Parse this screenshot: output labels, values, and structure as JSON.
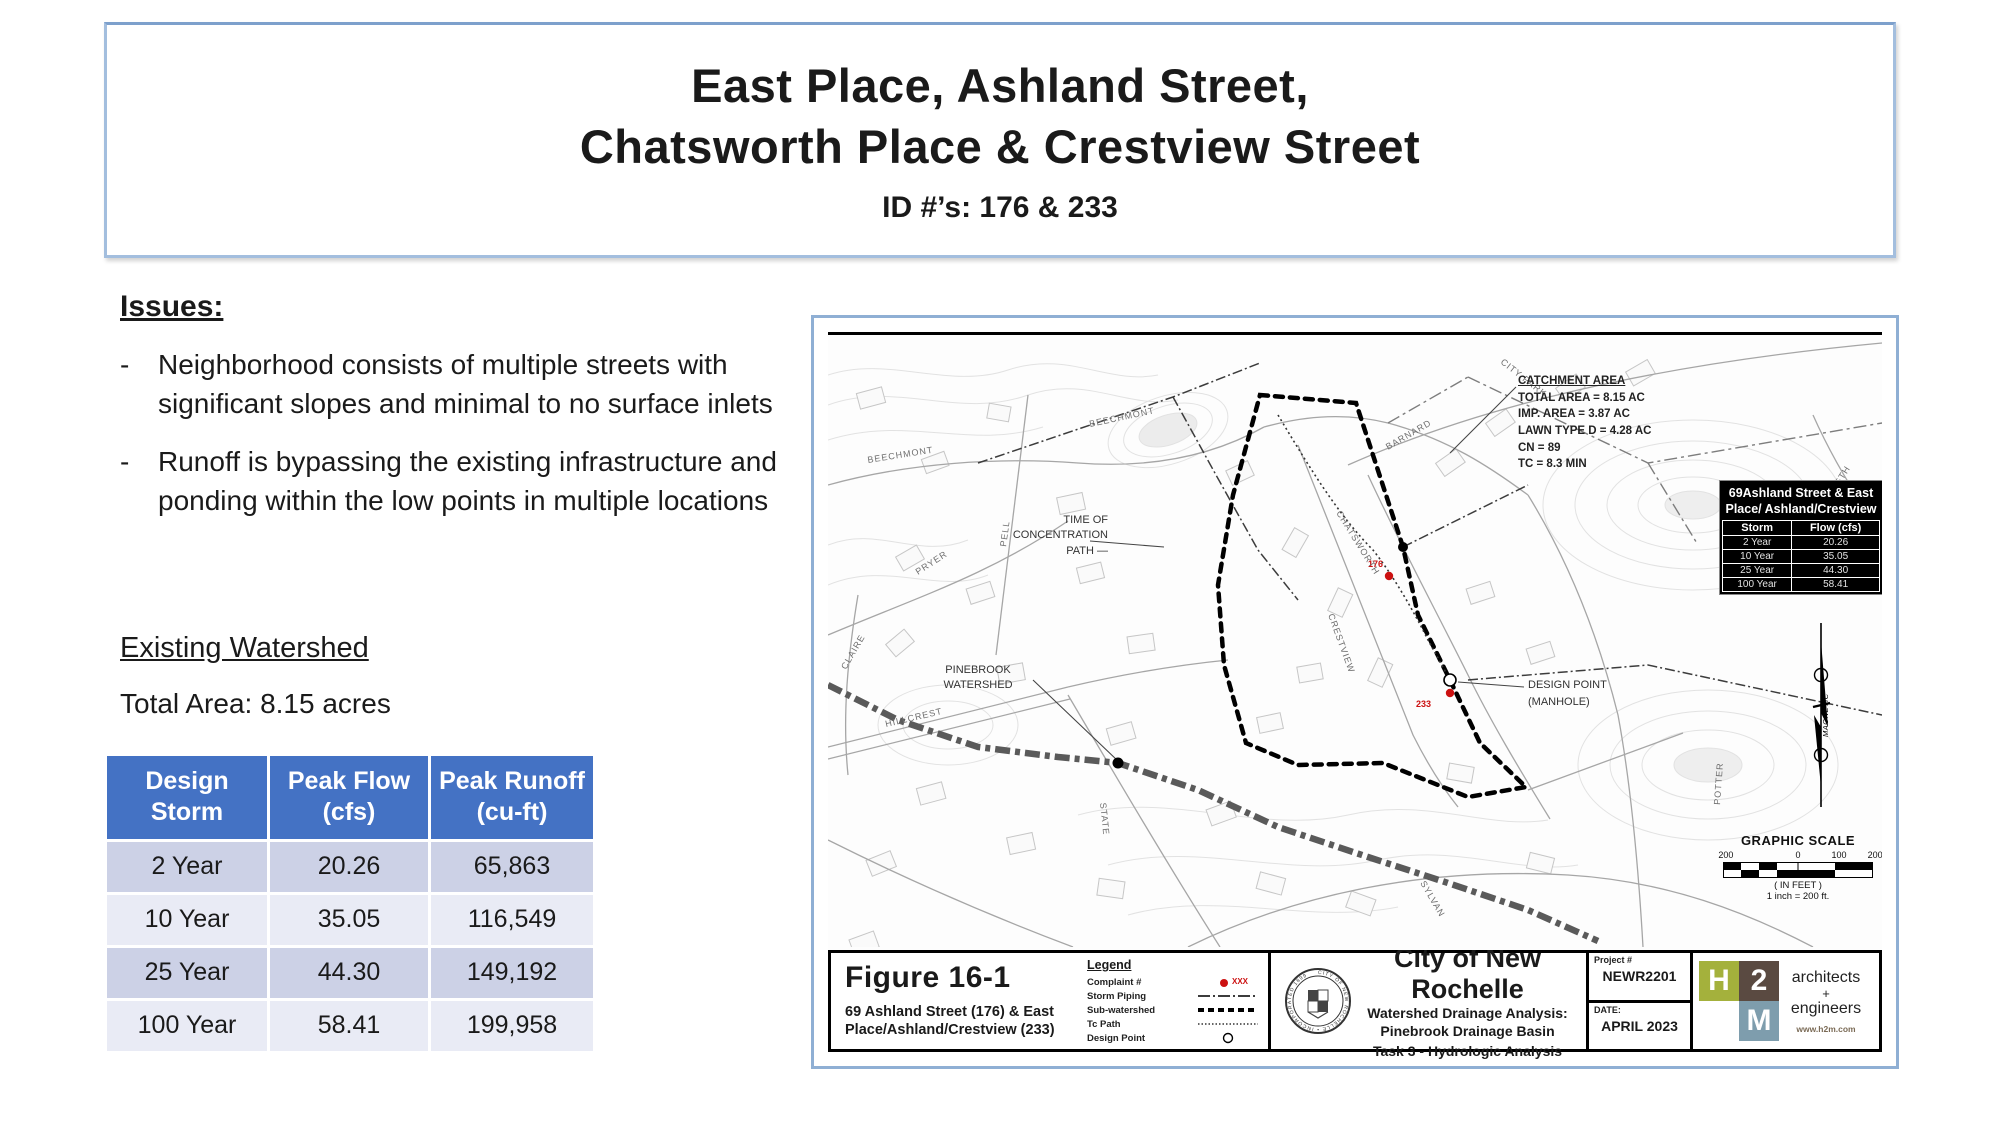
{
  "title": {
    "line1": "East Place, Ashland Street,",
    "line2": "Chatsworth Place & Crestview Street",
    "subtitle": "ID #’s: 176 & 233"
  },
  "issues": {
    "heading": "Issues:",
    "dash": "-",
    "items": [
      {
        "text": "Neighborhood consists of multiple streets with significant slopes and minimal to no surface inlets"
      },
      {
        "text": "Runoff is bypassing the existing infrastructure and ponding within the low points in multiple locations"
      }
    ]
  },
  "watershed": {
    "heading": "Existing Watershed",
    "total_area": "Total Area: 8.15 acres"
  },
  "storm_table": {
    "headers": [
      "Design Storm",
      "Peak Flow (cfs)",
      "Peak Runoff (cu-ft)"
    ],
    "rows": [
      [
        "2 Year",
        "20.26",
        "65,863"
      ],
      [
        "10 Year",
        "35.05",
        "116,549"
      ],
      [
        "25 Year",
        "44.30",
        "149,192"
      ],
      [
        "100 Year",
        "58.41",
        "199,958"
      ]
    ]
  },
  "map": {
    "catchment": {
      "title": "CATCHMENT AREA",
      "line1": "TOTAL AREA = 8.15 AC",
      "line2": "IMP. AREA = 3.87 AC",
      "line3": "LAWN TYPE D = 4.28 AC",
      "line4": "CN = 89",
      "line5": "TC = 8.3 MIN"
    },
    "inset_table": {
      "title_line1": "69Ashland Street & East",
      "title_line2": "Place/ Ashland/Crestview",
      "headers": [
        "Storm",
        "Flow (cfs)"
      ],
      "rows": [
        [
          "2 Year",
          "20.26"
        ],
        [
          "10 Year",
          "35.05"
        ],
        [
          "25 Year",
          "44.30"
        ],
        [
          "100 Year",
          "58.41"
        ]
      ]
    },
    "labels": {
      "toc1": "TIME OF",
      "toc2": "CONCENTRATION",
      "toc3": "PATH —",
      "pinebrook1": "PINEBROOK",
      "pinebrook2": "WATERSHED",
      "design_point1": "DESIGN POINT",
      "design_point2": "(MANHOLE)",
      "complaint_176": "176",
      "complaint_233": "233",
      "north": "MAGNETIC"
    },
    "streets": [
      "BEECHMONT",
      "BEECHMONT",
      "BARNARD",
      "PRYER",
      "PELL",
      "CLAIRE",
      "HILLCREST",
      "CRESTVIEW",
      "CHATSWORTH",
      "SYLVAN",
      "STATE",
      "POTTER",
      "5TH",
      "CITY PARK"
    ],
    "scale": {
      "title": "GRAPHIC SCALE",
      "tick1": "200",
      "tick2": "0",
      "tick3": "100",
      "tick4": "200",
      "unit": "( IN FEET )",
      "ratio": "1 inch =   200  ft."
    }
  },
  "titleblock": {
    "figure": "Figure 16-1",
    "figure_sub1": "69 Ashland Street (176) & East",
    "figure_sub2": "Place/Ashland/Crestview (233)",
    "legend": {
      "title": "Legend",
      "item1": "Complaint #",
      "item2": "Storm Piping",
      "item3": "Sub-watershed",
      "item4": "Tc Path",
      "item5": "Design Point",
      "complaint_value": "XXX"
    },
    "agency": {
      "name": "City of New Rochelle",
      "sub1": "Watershed Drainage Analysis:",
      "sub2": "Pinebrook Drainage Basin",
      "sub3": "Task 3 - Hydrologic Analysis",
      "seal_text": "CITY OF NEW ROCHELLE • INCORPORATED 1899"
    },
    "project": {
      "label": "Project #",
      "value": "NEWR2201",
      "date_label": "DATE:",
      "date": "APRIL 2023"
    },
    "firm": {
      "h": "H",
      "two": "2",
      "m": "M",
      "desc1": "architects",
      "plus": "+",
      "desc2": "engineers",
      "site": "www.h2m.com"
    }
  },
  "colors": {
    "table_header": "#4472c4",
    "row_dark": "#ccd1e6",
    "row_light": "#e9ebf5",
    "frame_blue": "#8fafd4",
    "complaint_red": "#cc1111"
  }
}
